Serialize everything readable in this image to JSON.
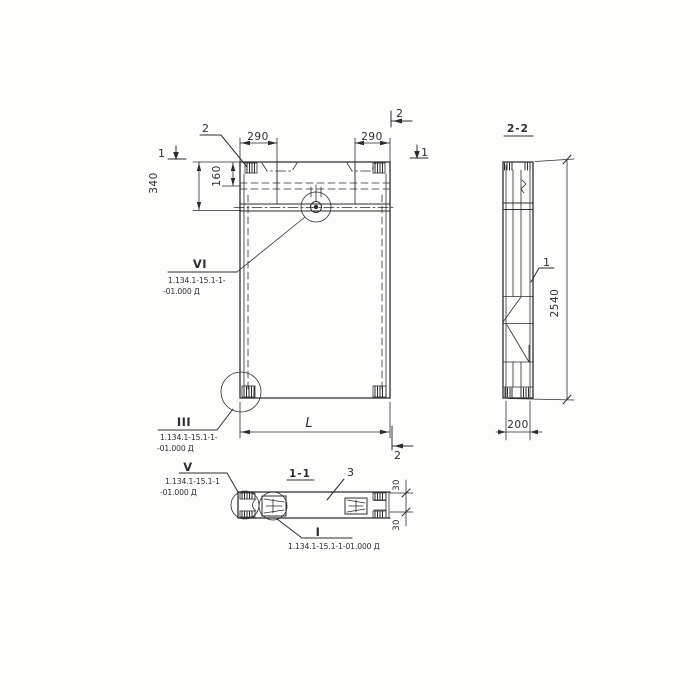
{
  "drawing": {
    "background": "#fdfdfc",
    "ink": "#2d2d2d",
    "front_view": {
      "dim_290_left": "290",
      "dim_290_right": "290",
      "dim_160": "160",
      "dim_340": "340",
      "dim_length": "L",
      "section_mark_1_left": "1",
      "section_mark_1_right": "1",
      "section_mark_2_top": "2",
      "section_mark_2_bottom": "2",
      "leader_label_2": "2"
    },
    "side_view": {
      "title": "2-2",
      "dim_height": "2540",
      "dim_width": "200",
      "leader_label_1": "1"
    },
    "section_view": {
      "title": "1-1",
      "leader_label_3": "3",
      "dim_30_top": "30",
      "dim_30_bottom": "30"
    },
    "callouts": {
      "vi": {
        "roman": "VI",
        "line1": "1.134.1-15.1-1-",
        "line2": "-01.000 Д"
      },
      "iii": {
        "roman": "III",
        "line1": "1.134.1-15.1-1-",
        "line2": "-01.000 Д"
      },
      "v": {
        "roman": "V",
        "line1": "1.134.1-15.1-1",
        "line2": "-01.000 Д"
      },
      "i": {
        "roman": "I",
        "label": "1.134.1-15.1-1-01.000 Д"
      }
    }
  }
}
